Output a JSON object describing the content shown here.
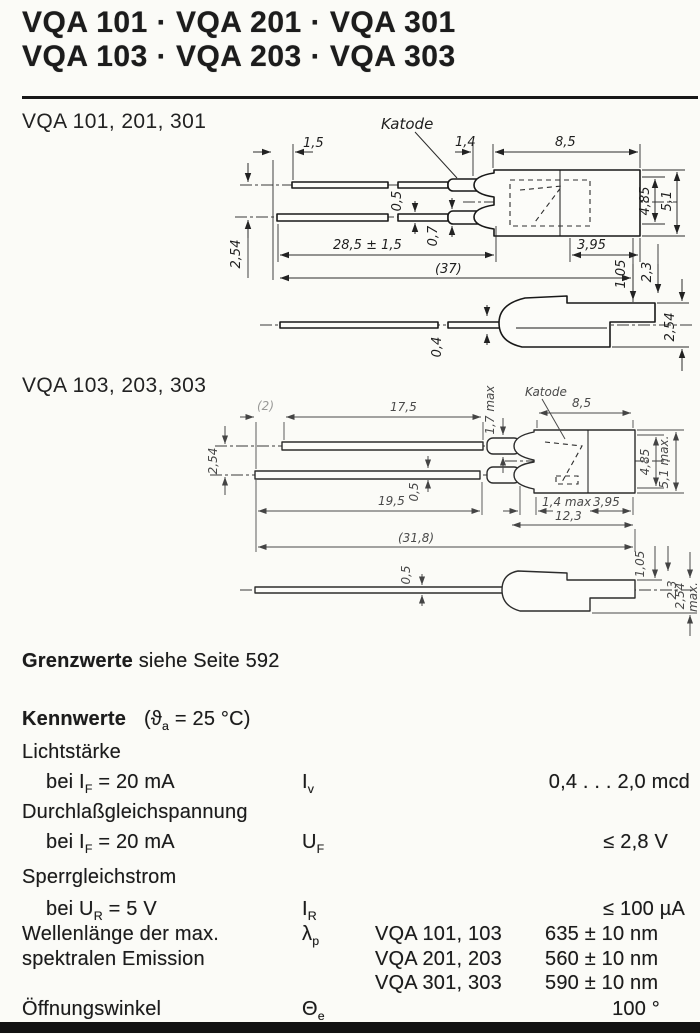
{
  "header": {
    "line1": "VQA 101 · VQA 201 · VQA 301",
    "line2": "VQA 103 · VQA 203 · VQA 303"
  },
  "section1": {
    "label": "VQA 101, 201, 301",
    "katode": "Katode",
    "dims": {
      "d1_5": "1,5",
      "d1_4": "1,4",
      "d8_5": "8,5",
      "d0_5": "0,5",
      "d0_7": "0,7",
      "d28_5": "28,5 ± 1,5",
      "d37": "(37)",
      "d3_95": "3,95",
      "d4_85": "4,85",
      "d5_1": "5,1",
      "d2_54_left": "2,54",
      "d1_05": "1,05",
      "d2_3": "2,3",
      "d0_4": "0,4",
      "d2_54_right": "2,54"
    }
  },
  "section2": {
    "label": "VQA 103, 203, 303",
    "katode": "Katode",
    "dims": {
      "d2": "(2)",
      "d17_5": "17,5",
      "d1_7": "1,7 max",
      "d8_5": "8,5",
      "d2_54": "2,54",
      "d4_85": "4,85",
      "d5_1": "5,1 max.",
      "d19_5": "19,5",
      "d0_5": "0,5",
      "d1_4": "1,4 max",
      "d3_95": "3,95",
      "d12_3": "12,3",
      "d31_8": "(31,8)",
      "s0_5": "0,5",
      "s1_05": "1,05",
      "s2_3": "2,3",
      "s2_54": "2,54",
      "smax": "max."
    }
  },
  "grenzwerte": {
    "bold": "Grenzwerte",
    "rest": " siehe Seite 592"
  },
  "kennwerte": {
    "heading": "Kennwerte",
    "cond_pre": "(ϑ",
    "cond_sub": "a",
    "cond_post": " = 25 °C)",
    "rows": {
      "lichtstaerke": {
        "group": "Lichtstärke",
        "label_pre": "bei I",
        "label_sub": "F",
        "label_post": " = 20 mA",
        "sym": "I",
        "sym_sub": "v",
        "value": "0,4 . . . 2,0 mcd"
      },
      "durchlass": {
        "group": "Durchlaßgleichspannung",
        "label_pre": "bei I",
        "label_sub": "F",
        "label_post": " = 20 mA",
        "sym": "U",
        "sym_sub": "F",
        "value": "≤ 2,8 V"
      },
      "sperr": {
        "group": "Sperrgleichstrom",
        "label_pre": "bei U",
        "label_sub": "R",
        "label_post": " = 5 V",
        "sym": "I",
        "sym_sub": "R",
        "value": "≤ 100 µA"
      },
      "wellenlaenge": {
        "label_line1": "Wellenlänge der max.",
        "label_line2": "spektralen Emission",
        "sym": "λ",
        "sym_sub": "p",
        "entries": [
          {
            "types": "VQA 101, 103",
            "value": "635 ± 10 nm"
          },
          {
            "types": "VQA 201, 203",
            "value": "560 ± 10 nm"
          },
          {
            "types": "VQA 301, 303",
            "value": "590 ± 10 nm"
          }
        ]
      },
      "oeffnungswinkel": {
        "label": "Öffnungswinkel",
        "sym": "Θ",
        "sym_sub": "e",
        "value": "100 °"
      }
    }
  }
}
